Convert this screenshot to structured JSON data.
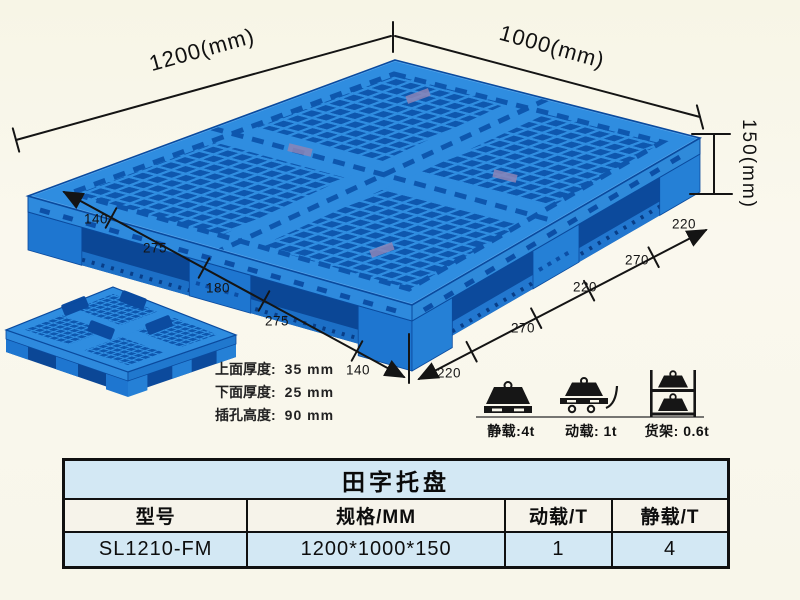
{
  "pallet": {
    "dim_width": "1200(mm)",
    "dim_depth": "1000(mm)",
    "dim_height": "150(mm)",
    "left_segments": [
      "140",
      "275",
      "180",
      "275",
      "140"
    ],
    "right_segments": [
      "220",
      "270",
      "220",
      "270",
      "220"
    ]
  },
  "specs": {
    "lines": [
      {
        "label": "上面厚度:",
        "value": "35 mm"
      },
      {
        "label": "下面厚度:",
        "value": "25 mm"
      },
      {
        "label": "插孔高度:",
        "value": "90 mm"
      }
    ]
  },
  "loads": {
    "static": {
      "icon": "weight-on-pallet-icon",
      "label": "静载:4t"
    },
    "dynamic": {
      "icon": "weight-on-trolley-icon",
      "label": "动载: 1t"
    },
    "rack": {
      "icon": "stacked-rack-icon",
      "label": "货架: 0.6t"
    }
  },
  "table": {
    "title": "田字托盘",
    "headers": [
      "型号",
      "规格/MM",
      "动载/T",
      "静载/T"
    ],
    "row": [
      "SL1210-FM",
      "1200*1000*150",
      "1",
      "4"
    ]
  },
  "colors": {
    "pallet_blue": "#2f8de0",
    "pallet_hole_dark": "#0e57ae",
    "pallet_side_left": "#2e8add",
    "pallet_side_right": "#2078ce",
    "pallet_interior": "#0b4796",
    "table_blue": "#d3e8f4",
    "header_cream": "#f6f3ea",
    "background_cream": "#f8f6ea",
    "line_black": "#151515"
  }
}
